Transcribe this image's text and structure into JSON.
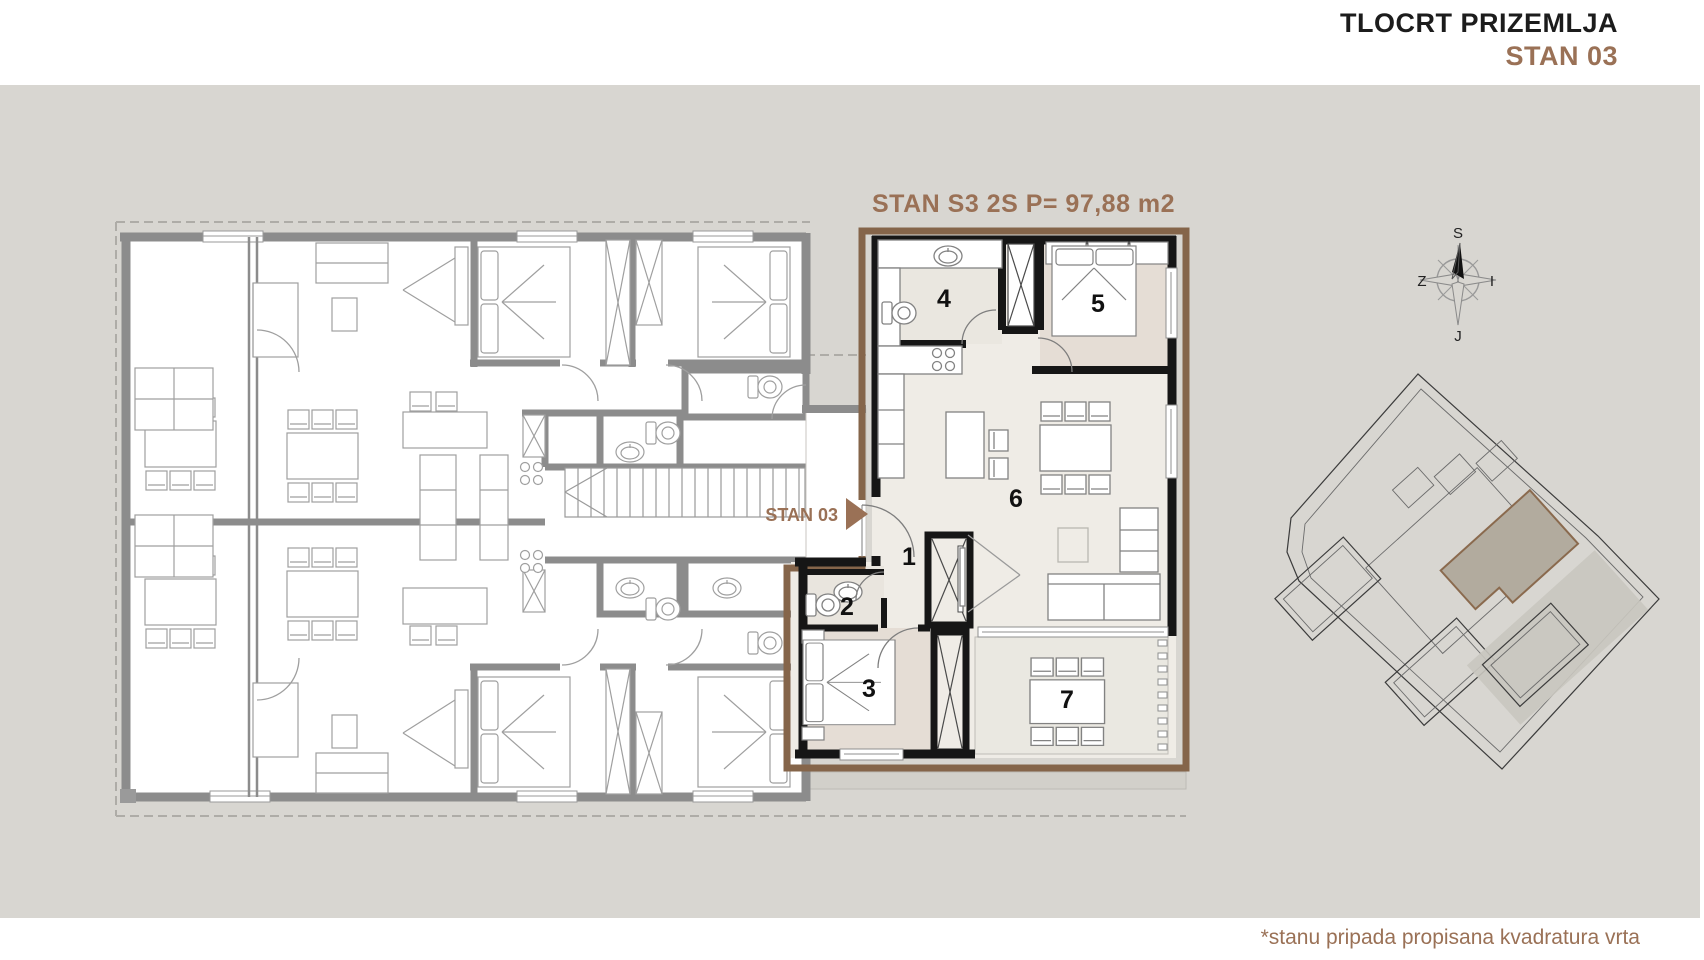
{
  "header": {
    "title": "TLOCRT PRIZEMLJA",
    "subtitle": "STAN 03"
  },
  "plan": {
    "apartment_title": "STAN S3 2S P= 97,88 m2",
    "entrance_label": "STAN 03",
    "rooms": [
      {
        "number": "1"
      },
      {
        "number": "2"
      },
      {
        "number": "3"
      },
      {
        "number": "4"
      },
      {
        "number": "5"
      },
      {
        "number": "6"
      },
      {
        "number": "7"
      }
    ]
  },
  "compass": {
    "north": "S",
    "south": "J",
    "west": "Z",
    "east": "I"
  },
  "footer": {
    "note": "*stanu pripada propisana kvadratura vrta"
  },
  "colors": {
    "accent_brown": "#9a7156",
    "outline_brown": "#85654a",
    "background_gray": "#d8d6d1",
    "apartment_floor": "#efece6",
    "bedroom_floor": "#e5ddd5",
    "terrace_floor": "#eae8e1",
    "muted_wall_gray": "#8c8c8c",
    "site_highlight": "#b2ab9e"
  }
}
